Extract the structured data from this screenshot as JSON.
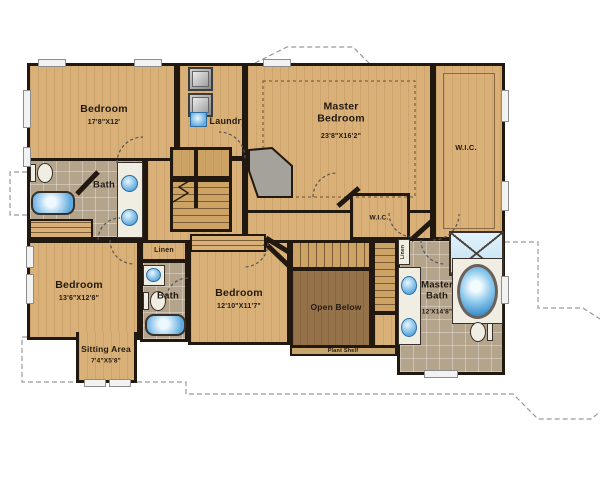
{
  "plan": {
    "rooms": {
      "bedroom_top_left": {
        "name": "Bedroom",
        "dims": "17'8\"X12'"
      },
      "laundry": {
        "name": "Laundry"
      },
      "master_bedroom": {
        "name": "Master Bedroom",
        "dims": "23'8\"X16'2\""
      },
      "wic_master": {
        "name": "W.I.C."
      },
      "wic_hall": {
        "name": "W.I.C."
      },
      "bath_upper": {
        "name": "Bath"
      },
      "bath_middle": {
        "name": "Bath"
      },
      "master_bath": {
        "name": "Master Bath",
        "dims": "12'X14'8\""
      },
      "bedroom_middle": {
        "name": "Bedroom",
        "dims": "12'10\"X11'7\""
      },
      "bedroom_bottom_left": {
        "name": "Bedroom",
        "dims": "13'6\"X12'8\""
      },
      "sitting_area": {
        "name": "Sitting Area",
        "dims": "7'4\"X5'8\""
      },
      "linen_hall": {
        "name": "Linen"
      },
      "linen_master": {
        "name": "Linen"
      },
      "open_below": {
        "name": "Open Below"
      },
      "plant_shelf": {
        "name": "Plant Shelf"
      }
    },
    "colors": {
      "floor_wood": "#d9b077",
      "floor_tile": "#b5a48c",
      "open_below": "#95724a",
      "wall": "#211810",
      "water": "#5fabdf",
      "fixture": "#f0ede3",
      "window": "#f2f2f2"
    }
  }
}
